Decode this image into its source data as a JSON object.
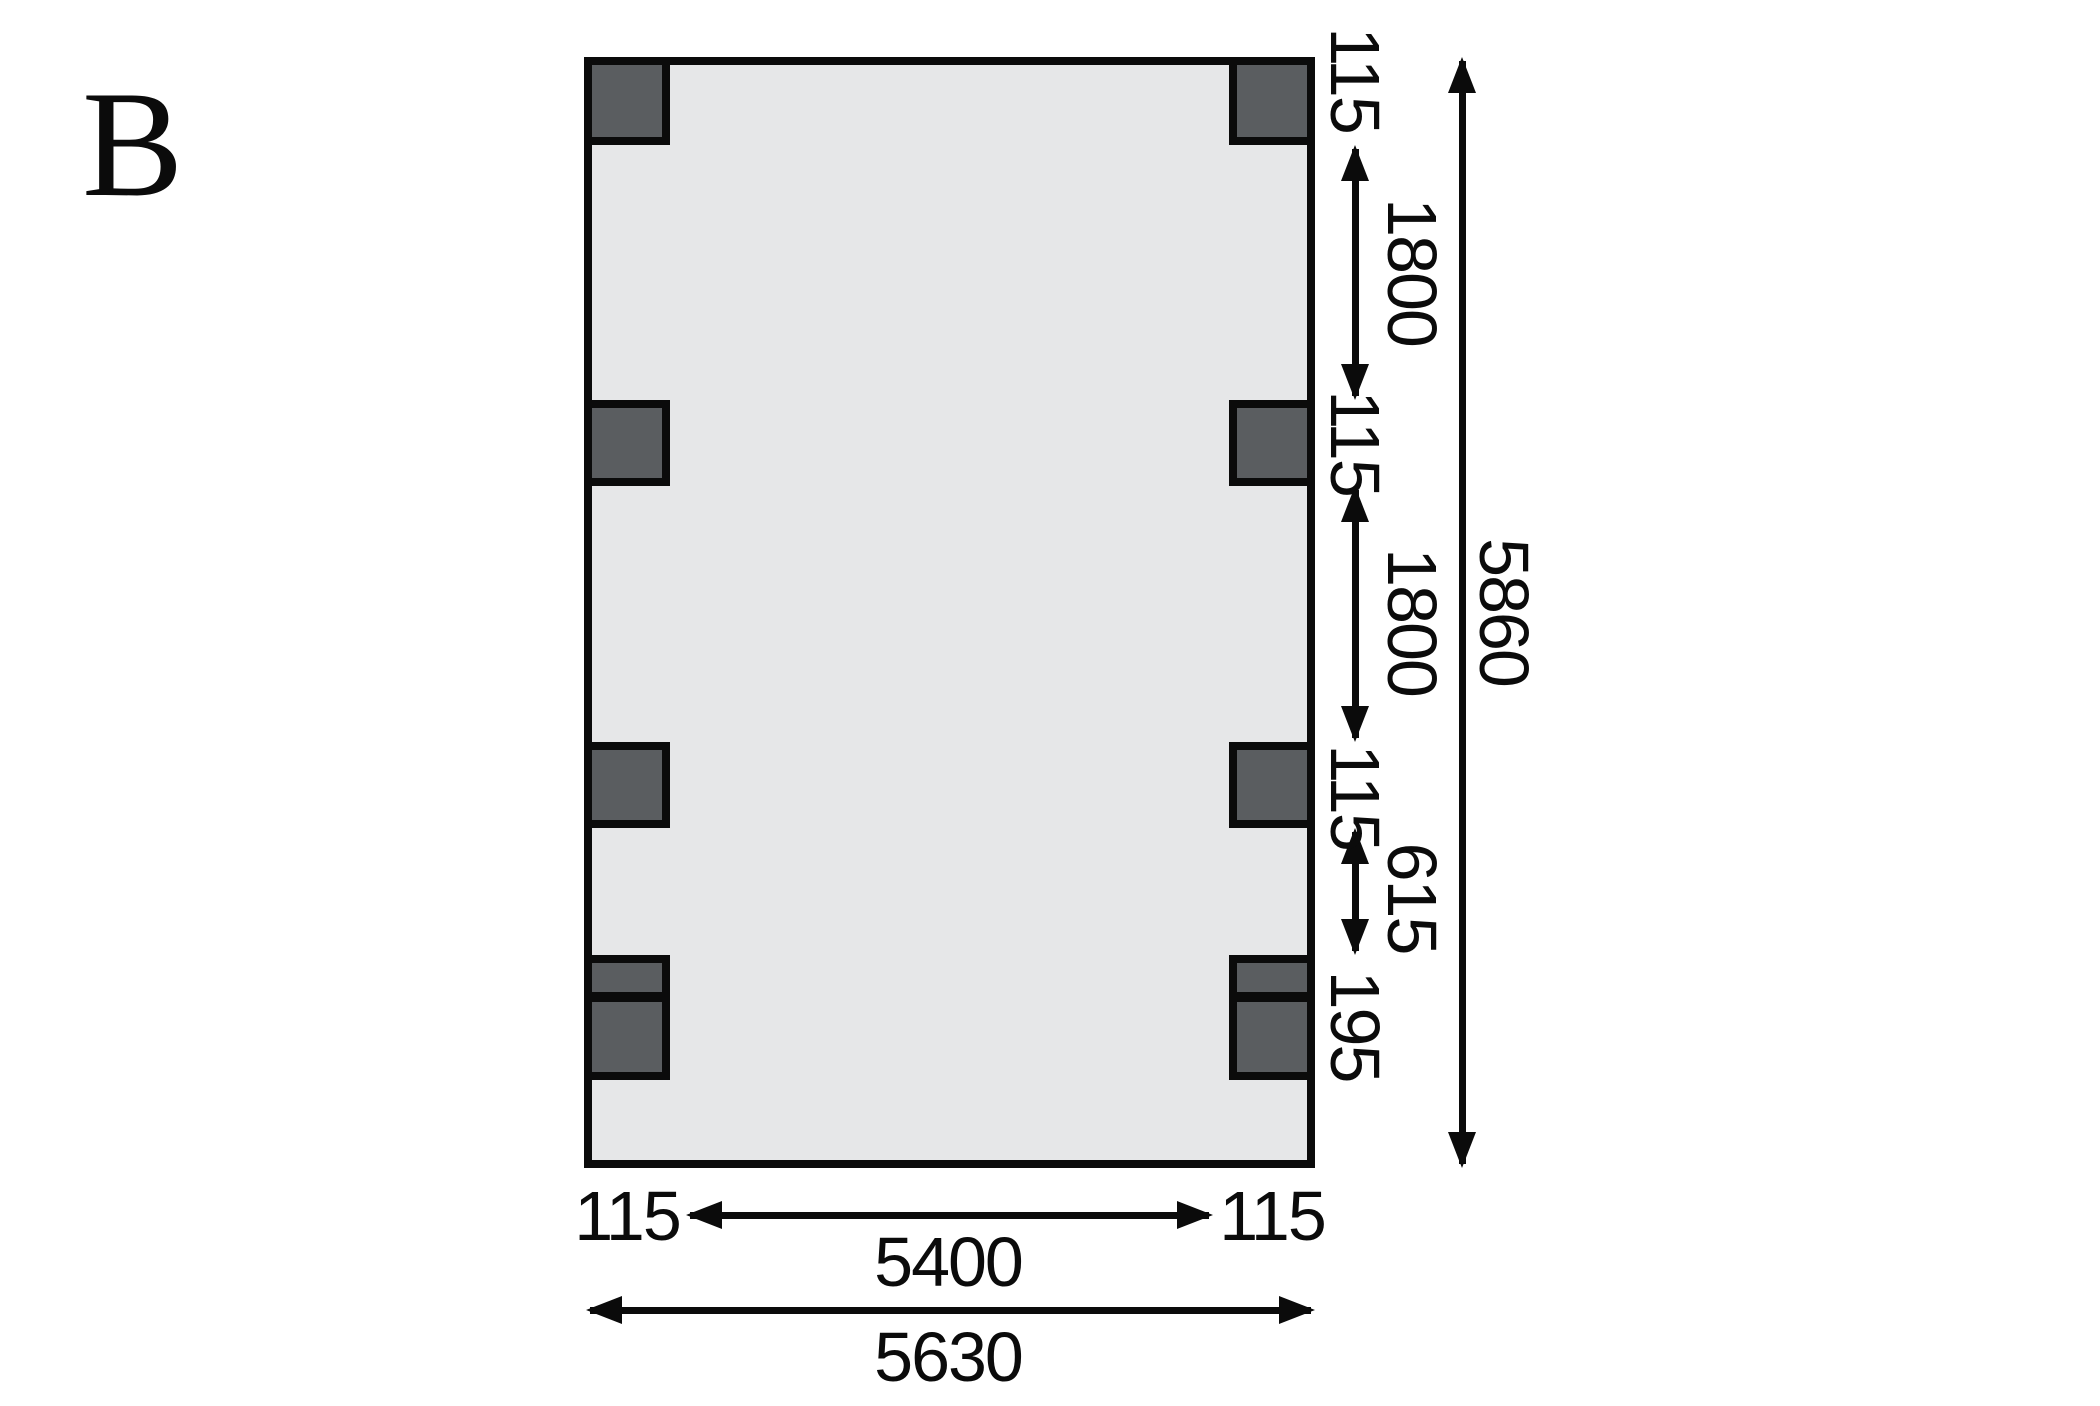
{
  "figure": {
    "label": "B"
  },
  "colors": {
    "background": "#ffffff",
    "floor_fill": "#e6e7e8",
    "post_fill": "#5a5d60",
    "line": "#0b0b0b"
  },
  "labels": {
    "right": [
      {
        "id": "post-width-top",
        "value": "115"
      },
      {
        "id": "post-spacing-1",
        "value": "1800"
      },
      {
        "id": "post-width-middle",
        "value": "115"
      },
      {
        "id": "post-spacing-2",
        "value": "1800"
      },
      {
        "id": "post-width-lower",
        "value": "115"
      },
      {
        "id": "post-spacing-3",
        "value": "615"
      },
      {
        "id": "anchor-length",
        "value": "195"
      },
      {
        "id": "overall-depth",
        "value": "5860"
      }
    ],
    "bottom": [
      {
        "id": "post-width-left",
        "value": "115"
      },
      {
        "id": "inner-span",
        "value": "5400"
      },
      {
        "id": "post-width-right",
        "value": "115"
      },
      {
        "id": "overall-width",
        "value": "5630"
      }
    ]
  }
}
